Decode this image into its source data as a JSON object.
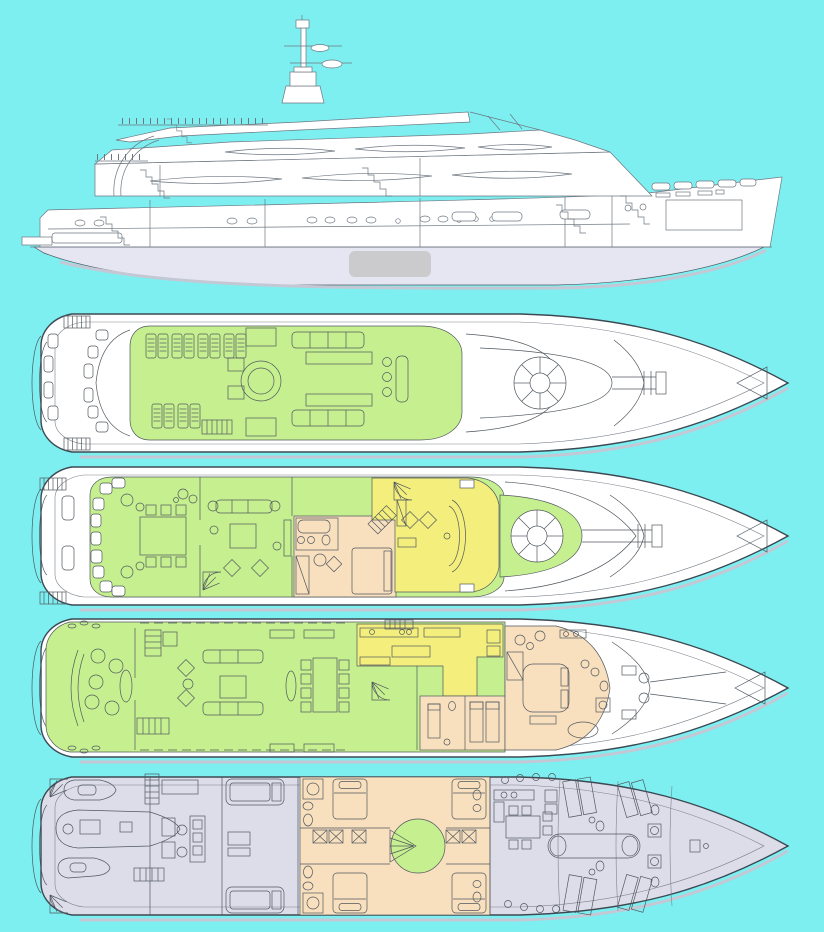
{
  "palette": {
    "background": "#7DEFF1",
    "hull_white": "#FFFFFF",
    "underwater_hull": "#E6E6F3",
    "zone_green": "#C6F08F",
    "zone_yellow": "#F4EF7C",
    "zone_peach": "#F8DFBE",
    "zone_lavender": "#DDDDEA",
    "outline_dark": "#3C4852",
    "detail_line": "#50585F",
    "shadow": "#C4C8D4",
    "gray_patch": "#CBCBCE"
  },
  "views": {
    "side_profile": {
      "zones": [
        "hull_white",
        "underwater_hull"
      ]
    },
    "deck_plans": [
      {
        "id": "sun-deck",
        "zones": [
          "zone_green"
        ]
      },
      {
        "id": "bridge-deck",
        "zones": [
          "zone_green",
          "zone_yellow",
          "zone_peach"
        ]
      },
      {
        "id": "main-deck",
        "zones": [
          "zone_green",
          "zone_yellow",
          "zone_peach"
        ]
      },
      {
        "id": "lower-deck",
        "zones": [
          "zone_lavender",
          "zone_peach",
          "zone_green"
        ]
      }
    ]
  }
}
